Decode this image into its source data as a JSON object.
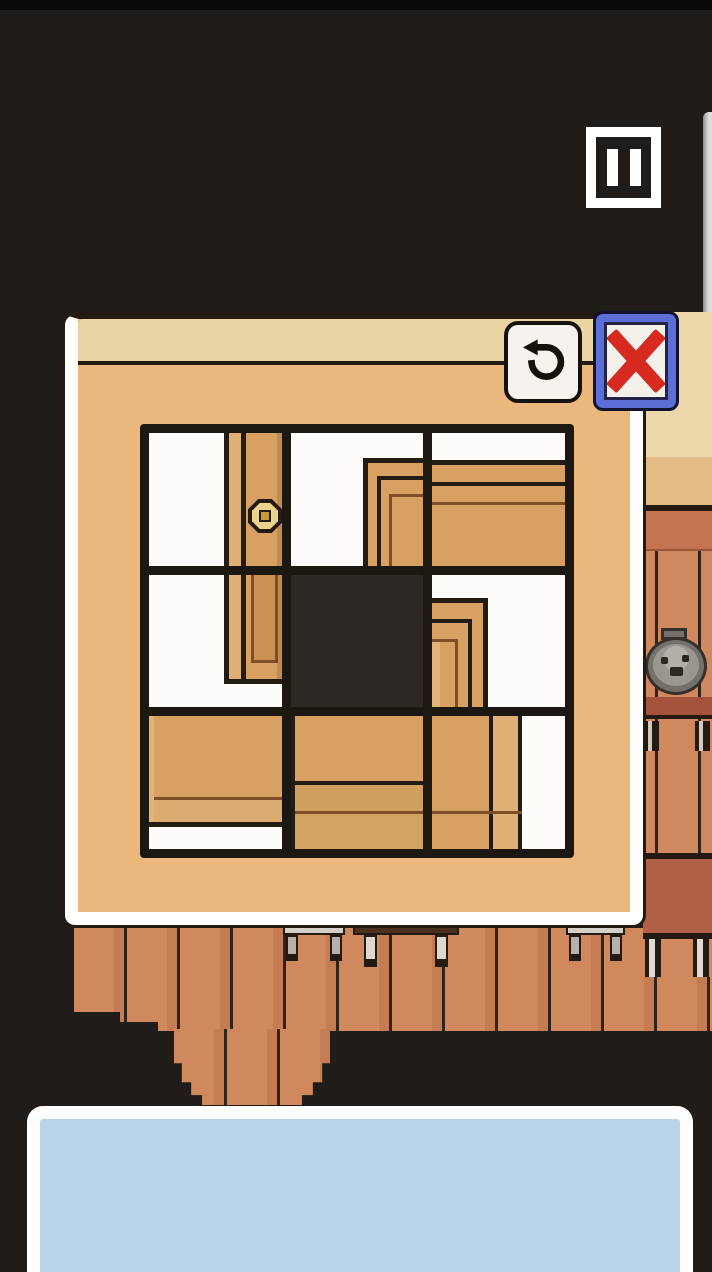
{
  "meta": {
    "app_type": "pixel-art room escape puzzle game",
    "view": "sliding tile door puzzle dialog over room scene"
  },
  "colors": {
    "background": "#1f1c19",
    "panel_body": "#eab87d",
    "panel_topbar": "#e9d5a4",
    "panel_border": "#ffffff",
    "outline_dark": "#241a12",
    "grid_cell_white": "#fdfcfa",
    "grid_hole_black": "#2c2925",
    "wood_main": "#d7a164",
    "wood_light": "#e0b176",
    "wood_shade": "#c18a50",
    "wood_line_brown": "#7e4e26",
    "wall_plank": "#d0895c",
    "cabinet_top_band": "#c47450",
    "cabinet_shelf": "#a5523c",
    "cabinet_drawer": "#b25f47",
    "cream_wall": "#ecd8aa",
    "cream_wall_lower": "#e2bc84",
    "close_frame_blue": "#5b6fd6",
    "close_x_red": "#d6291f",
    "button_face": "#f6f3ee",
    "dialog_blue": "#b9d3e9",
    "knob_gold": "#ecd28c",
    "knob_center": "#c89a36",
    "stone_gray": "#9b9790"
  },
  "hud": {
    "pause_button": {
      "icon": "pause-icon",
      "label": "Pause"
    }
  },
  "puzzle_panel": {
    "undo_button": {
      "icon": "undo-rotate-icon",
      "label": "Reset / undo move"
    },
    "close_button": {
      "icon": "close-x-icon",
      "label": "Close puzzle"
    },
    "grid": {
      "rows": 3,
      "cols": 3,
      "hole": {
        "row": 1,
        "col": 1
      },
      "tiles": [
        {
          "row": 0,
          "col": 0,
          "content": "white tile with vertical door stile and gold knob"
        },
        {
          "row": 0,
          "col": 1,
          "content": "white tile with mitered top-left corner of door frame"
        },
        {
          "row": 0,
          "col": 2,
          "content": "wood tile with door top rail and frame lines"
        },
        {
          "row": 1,
          "col": 0,
          "content": "white tile with lower end of door stile and inset panel"
        },
        {
          "row": 1,
          "col": 1,
          "content": "empty black hole"
        },
        {
          "row": 1,
          "col": 2,
          "content": "white tile with frame corner opening upward"
        },
        {
          "row": 2,
          "col": 0,
          "content": "wood tile with horizontal board edge, white sliver below"
        },
        {
          "row": 2,
          "col": 1,
          "content": "full wood tile with panel lines"
        },
        {
          "row": 2,
          "col": 2,
          "content": "wood stile strip on left, white on right"
        }
      ]
    }
  },
  "scene": {
    "edge_highlight": "white screen-edge sliver",
    "right_wall": "cream plaster wall",
    "cabinet": {
      "stone": "gray stone pot lid with face-like holes",
      "shelf": "red shelf board",
      "drawer": "red drawer front with feet"
    },
    "lower_wall": "salmon plank wainscot with hanging center column",
    "furniture": [
      {
        "name": "metal stool",
        "position": "left of center"
      },
      {
        "name": "dark wooden table",
        "position": "center"
      },
      {
        "name": "metal stool",
        "position": "right"
      },
      {
        "name": "cabinet legs",
        "position": "far right"
      }
    ]
  },
  "dialog": {
    "text": ""
  }
}
